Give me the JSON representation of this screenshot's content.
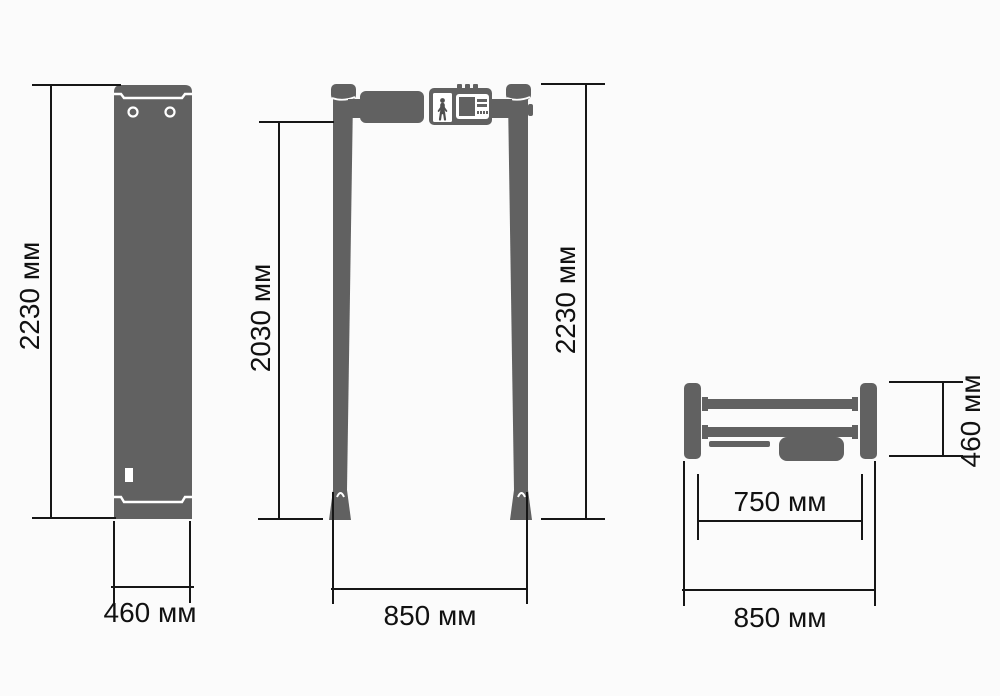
{
  "views": {
    "side": {
      "height_label": "2230 мм",
      "width_label": "460 мм"
    },
    "front": {
      "inner_height_label": "2030 мм",
      "height_label": "2230 мм",
      "width_label": "850 мм"
    },
    "top": {
      "depth_label": "460 мм",
      "inner_width_label": "750 мм",
      "width_label": "850 мм"
    }
  },
  "colors": {
    "body_gray": "#616161",
    "line_black": "#161616",
    "background": "#fbfbfb",
    "text": "#111111"
  }
}
